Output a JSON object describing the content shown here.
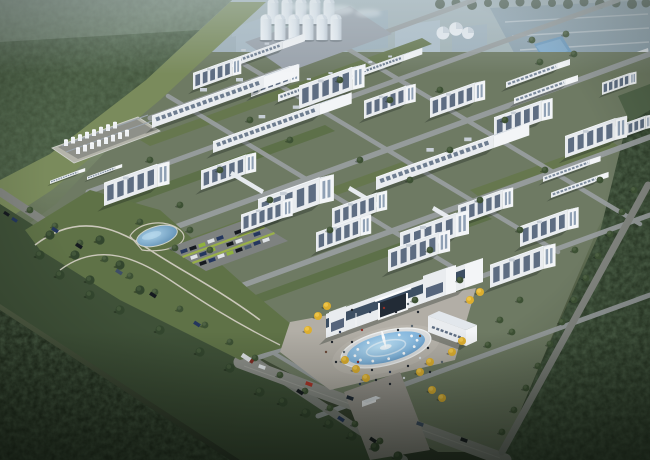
{
  "scene": {
    "description": "Aerial rendering of an industrial park campus at dusk: grid of white factory buildings and warehouses, silo cluster, tank farm, landscaped park with pond and parking lot, main entrance gate building with fountain plaza, surrounded by dense forest and perimeter roads",
    "skyline": "hazy distant industrial plant with flat blue-gray roofs and steam plumes",
    "counts": {
      "silos": 11,
      "gas_domes": 3,
      "factory_buildings": 20,
      "warehouses": 6,
      "long_sheds": 6,
      "parked_cars": 21,
      "road_vehicles": 16,
      "plaza_people": 28
    },
    "landmarks": [
      "silo-cluster",
      "tank-farm",
      "park-pond",
      "retention-pond",
      "parking-lot",
      "entrance-gate-building",
      "fountain",
      "plaza",
      "gatehouse",
      "ginkgo-trees",
      "forest-top-left",
      "forest-bottom-left",
      "forest-right-band",
      "meadow",
      "perimeter-road",
      "front-avenue",
      "right-perimeter-road"
    ]
  },
  "palette": {
    "sky_haze": "#b5c1c7",
    "haze_green": "#9fae9f",
    "ground_mid": "#79886c",
    "ground_dark": "#535f46",
    "forest": "#45573f",
    "forest_dark": "#243020",
    "forest_right": "#2e3d2a",
    "meadow": "#7a8b5c",
    "campus_ground": "#6e7a63",
    "lawn": "#66774e",
    "lawn_dark": "#5d7049",
    "road": "#989d9e",
    "road_dark": "#838681",
    "avenue": "#8d8f8a",
    "wall_front": "#e9ecef",
    "wall_end": "#f3f5f7",
    "roof": "#e2e7ec",
    "roof_w": "#dde3ea",
    "win": "#5e6d82",
    "win_light": "#8fa0b4",
    "glass_band": "#3d4f63",
    "silo": "#edf2f6",
    "concrete": "#a7aeb4",
    "apron": "#b4b4aa",
    "pond": "#5e93c2",
    "pond_light": "#bfe3f7",
    "fountain_rim": "#dcdedf",
    "plaza": "#b2aea6",
    "plaza_dark": "#9b9791",
    "tree": "#3d5134",
    "tree_light": "#55684a",
    "park_tree": "#33462e",
    "ginkgo": "#dcae2f",
    "ginkgo_light": "#f0c84d",
    "bush": "#9cb544",
    "car_navy": "#24365e",
    "car_black": "#15191f",
    "car_green": "#8fb23e",
    "car_white": "#dfe3e6",
    "car_red": "#b03428",
    "distant_box": "#a8b9c4",
    "distant_roof": "#8ea2ae",
    "steam": "#e8eef2"
  }
}
